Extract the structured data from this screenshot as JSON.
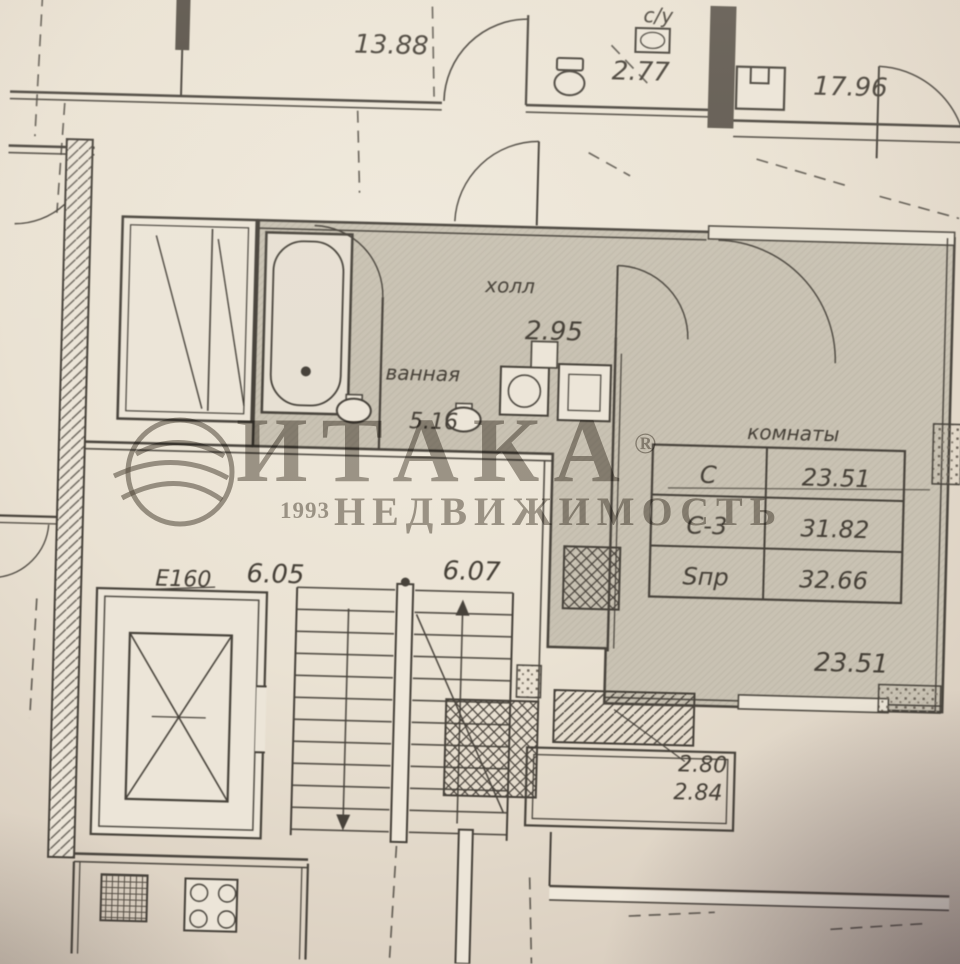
{
  "watermark": {
    "brand": "ИТАКА",
    "reg": "®",
    "year": "1993",
    "subtitle": "НЕДВИЖИМОСТЬ",
    "color": "#564e44"
  },
  "plan": {
    "ink": "#47423a",
    "paper": "#ece5d7",
    "room_fill": "#c9c2b2",
    "labels": {
      "top_left_area": "13.88",
      "wc_abbr": "с/у",
      "wc_area": "2.77",
      "top_right_area": "17.96",
      "hall_name": "холл",
      "hall_area": "2.95",
      "bath_name": "ванная",
      "bath_area": "5.16",
      "landing_left": "6.05",
      "landing_right": "6.07",
      "elevator": "Е160",
      "room_area": "23.51",
      "balcony_dim_1": "2.80",
      "balcony_dim_2": "2.84"
    },
    "area_table": {
      "title": "комнаты",
      "rows": [
        {
          "label": "С",
          "value": "23.51"
        },
        {
          "label": "С-3",
          "value": "31.82"
        },
        {
          "label": "Sпр",
          "value": "32.66"
        }
      ]
    }
  }
}
